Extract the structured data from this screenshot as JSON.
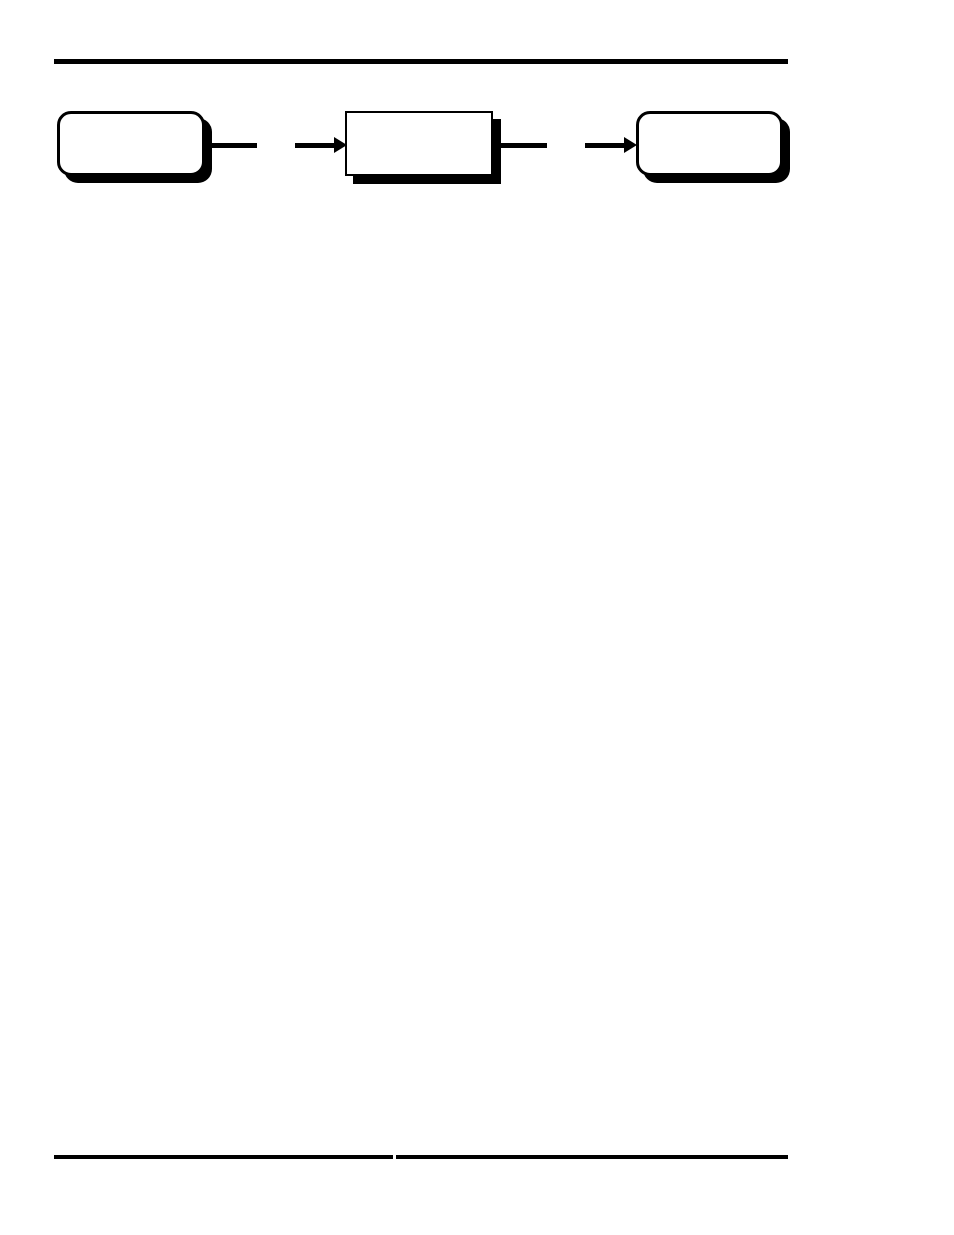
{
  "page": {
    "background_color": "#ffffff",
    "ink_color": "#000000"
  },
  "header": {
    "rule": "full-width horizontal rule"
  },
  "diagram": {
    "type": "flowchart",
    "direction": "left-to-right",
    "nodes": [
      {
        "id": "node-1",
        "shape": "rounded-rect",
        "label": ""
      },
      {
        "id": "node-2",
        "shape": "rect",
        "label": ""
      },
      {
        "id": "node-3",
        "shape": "rounded-rect",
        "label": ""
      }
    ],
    "connectors": [
      {
        "from": "node-1",
        "to": "node-2",
        "style": "broken-line",
        "head": "solid-right-triangle"
      },
      {
        "from": "node-2",
        "to": "node-3",
        "style": "broken-line",
        "head": "solid-right-triangle"
      }
    ]
  },
  "footer": {
    "rule": "horizontal rule split into two segments with small center gap"
  }
}
